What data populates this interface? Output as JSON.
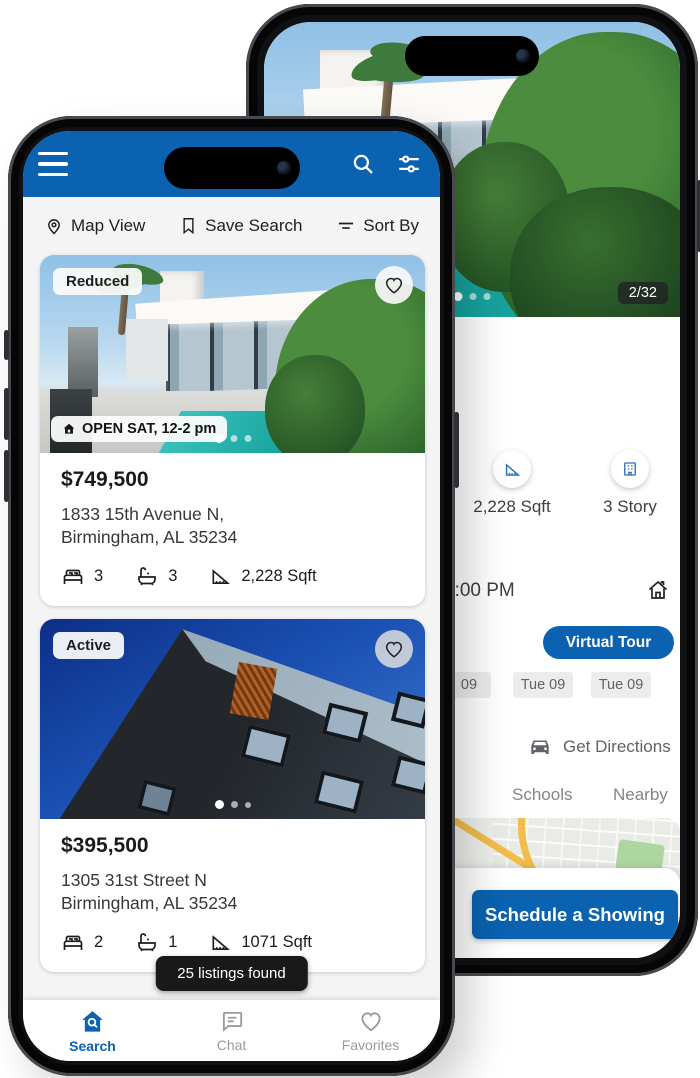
{
  "colors": {
    "brand_blue": "#0a62b1",
    "toast_bg": "#191919",
    "chip_bg": "#ececec"
  },
  "front_phone": {
    "header": {
      "icons": [
        "hamburger-menu",
        "search",
        "tune-filters"
      ]
    },
    "toolbar": {
      "map_view": "Map View",
      "save_search": "Save Search",
      "sort_by": "Sort By"
    },
    "listings": [
      {
        "status_badge": "Reduced",
        "open_house_badge": "OPEN SAT, 12-2 pm",
        "price": "$749,500",
        "address_line1": "1833 15th Avenue N,",
        "address_line2": "Birmingham, AL 35234",
        "beds": "3",
        "baths": "3",
        "sqft": "2,228 Sqft"
      },
      {
        "status_badge": "Active",
        "price": "$395,500",
        "address_line1": "1305 31st Street N",
        "address_line2": "Birmingham, AL 35234",
        "beds": "2",
        "baths": "1",
        "sqft": "1071 Sqft"
      }
    ],
    "toast": "25 listings found",
    "bottom_nav": [
      {
        "label": "Search",
        "active": true
      },
      {
        "label": "Chat",
        "active": false
      },
      {
        "label": "Favorites",
        "active": false
      }
    ]
  },
  "back_phone": {
    "photo_counter": "2/32",
    "stats": [
      {
        "label": "2,228 Sqft"
      },
      {
        "label": "3 Story"
      }
    ],
    "open_house_time": "2:00 PM",
    "virtual_tour_label": "Virtual Tour",
    "date_chips": [
      "09",
      "Tue 09",
      "Tue 09"
    ],
    "get_directions_label": "Get Directions",
    "tabs": [
      "Schools",
      "Nearby"
    ],
    "map_label": "ENWICH",
    "schedule_button_label": "Schedule a Showing"
  }
}
